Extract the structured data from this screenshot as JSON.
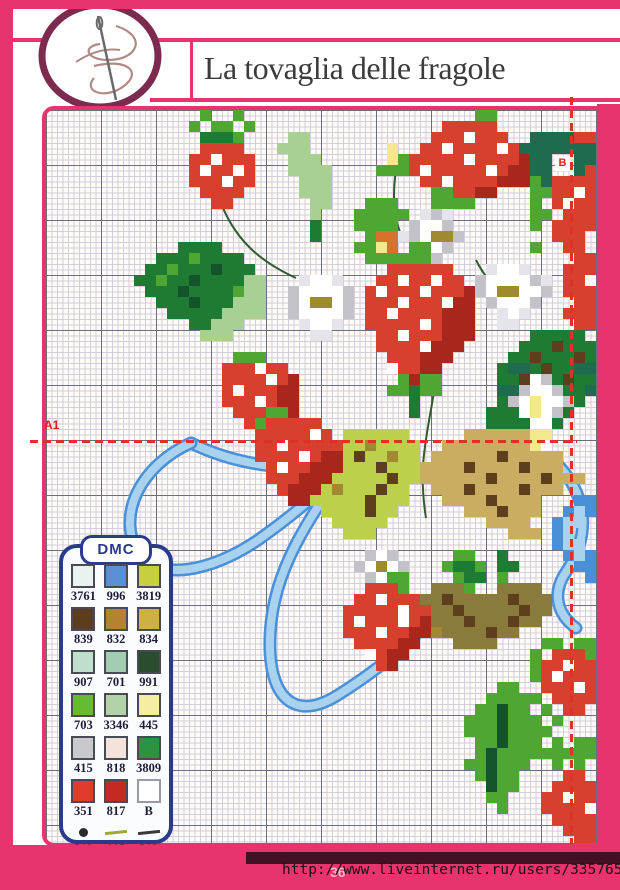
{
  "header": {
    "title": "La tovaglia delle fragole"
  },
  "footer": {
    "url": "http://www.liveinternet.ru/users/3357652/",
    "page_number": "36"
  },
  "legend": {
    "brand": "DMC",
    "entries": [
      {
        "code": "3761",
        "color": "#e9f2ef"
      },
      {
        "code": "996",
        "color": "#5b8fd6"
      },
      {
        "code": "3819",
        "color": "#c6cf3f"
      },
      {
        "code": "839",
        "color": "#5c3d20"
      },
      {
        "code": "832",
        "color": "#b28430"
      },
      {
        "code": "834",
        "color": "#cfb143"
      },
      {
        "code": "907",
        "color": "#bfdecb"
      },
      {
        "code": "701",
        "color": "#a3cdb3"
      },
      {
        "code": "991",
        "color": "#2c4c30"
      },
      {
        "code": "703",
        "color": "#66bb33"
      },
      {
        "code": "3346",
        "color": "#b2d2a6"
      },
      {
        "code": "445",
        "color": "#f4efa0"
      },
      {
        "code": "415",
        "color": "#c9c9cd"
      },
      {
        "code": "818",
        "color": "#f4e3da"
      },
      {
        "code": "3809",
        "color": "#2b9440"
      },
      {
        "code": "351",
        "color": "#e23a2e"
      },
      {
        "code": "817",
        "color": "#c32a21"
      },
      {
        "code": "B",
        "color": "#ffffff"
      }
    ],
    "symbols": [
      {
        "label": "310\np.\nnodi",
        "type": "dot",
        "color": "#2a2a2a"
      },
      {
        "label": "905\nps",
        "type": "line",
        "color": "#a3a832"
      },
      {
        "label": "310\nps",
        "type": "line",
        "color": "#3a3a3a"
      }
    ]
  },
  "pattern": {
    "markers": {
      "a1": "A1",
      "b": "B"
    },
    "cell_size": 11,
    "palette": {
      "r": "#d8402e",
      "R": "#a8261c",
      "w": "#ffffff",
      "g": "#4fa733",
      "G": "#1f7a33",
      "d": "#14542a",
      "k": "#1f6b4f",
      "l": "#a9d093",
      "Y": "#bcd04c",
      "y": "#f3e98c",
      "o": "#a08a30",
      "t": "#c9ad62",
      "n": "#8a7b3d",
      "b": "#5d3f1e",
      "B": "#4a90d9",
      "c": "#a9d2ef",
      "s": "#c2c2c8",
      "x": "#e4e4ea",
      "O": "#d9712c"
    },
    "motifs": [
      {
        "name": "right-teal-leaf",
        "col": 43,
        "row": 2,
        "rows": [
          ".kkkkrr",
          "kkkkkkk",
          "kkk..kk",
          "gkk..kr",
          ".gkkrrr"
        ]
      },
      {
        "name": "light-leaf-top",
        "col": 21,
        "row": 2,
        "rows": [
          ".ll",
          "lll",
          ".lll",
          ".llll",
          "..lll",
          "..lll",
          "...ll",
          "...l",
          "...G",
          "...G"
        ]
      },
      {
        "name": "left-big-leaf",
        "col": 8,
        "row": 12,
        "rows": [
          "....GGGG",
          "..GGGgGGGG",
          ".GGgGGGdGGG",
          "GGgGGdGGGGll",
          ".GGGdGGGGgll",
          "..GGGdGGGlll",
          "...GGGGGllll",
          ".....GGlll",
          "......lll"
        ]
      },
      {
        "name": "dark-mass-right",
        "col": 40,
        "row": 20,
        "rows": [
          "....GGGGG",
          "...GGGbGGG",
          "..GGbGGGbG",
          ".GkkGbGGkk",
          ".GGbGGGbGG",
          ".kkGGkkGGk",
          ".GGGGbGGG",
          "GGGbGGGG",
          "GGGGGGG"
        ]
      },
      {
        "name": "olive-leaf-center",
        "col": 24,
        "row": 29,
        "rows": [
          "...YYYYYY",
          "...YYoYYYY",
          "...YbYYoYY",
          "...YYYbYYY",
          "..YYYYYbYY",
          ".YoYYYbYY",
          "YYYYYbYYY",
          ".YYYYbYY",
          "..YYYYY",
          "...YYY"
        ]
      },
      {
        "name": "tan-leaf-right",
        "col": 34,
        "row": 29,
        "rows": [
          "....tttttt",
          "..tttttttttt",
          ".ttttttbttttt",
          "ttttbttttbttt",
          "ttttttbttttbttt",
          ".tttbttttbttt",
          "..ttttbtttt",
          "....tttbttt",
          "......tttt",
          "........ttt"
        ]
      },
      {
        "name": "brown-leaf-bottom",
        "col": 33,
        "row": 43,
        "rows": [
          "..nnnn..nnnn",
          ".nnbnnnnnbnnn",
          "nnnnbnnnnnbnn",
          ".onnnbnnnbnn",
          "..onnnnbnn",
          "....nnnn"
        ]
      },
      {
        "name": "oak-leaf-bottom",
        "col": 38,
        "row": 52,
        "rows": [
          "...gg",
          "..gggg",
          ".ggdgg",
          "gggdggg",
          "gggdgggg",
          ".ggdggg",
          ".gdgggg",
          "ggdggg",
          ".gdgg",
          "..dgg",
          "..gg",
          "...g"
        ]
      },
      {
        "name": "green-bits",
        "col": 35,
        "row": 40,
        "rows": [
          "..gg..G",
          ".gGGg.GG",
          "..gGG.g",
          "...g"
        ]
      },
      {
        "name": "green-mass",
        "col": 28,
        "row": 8,
        "rows": [
          ".ggg",
          "ggggg",
          "gggg",
          ".gOO",
          "ggyO",
          ".ggg"
        ]
      },
      {
        "name": "daisy-a",
        "col": 32,
        "row": 9,
        "rows": [
          "..xsx",
          ".swws",
          "xswoos",
          ".swws",
          "..xs"
        ]
      },
      {
        "name": "daisy-b",
        "col": 22,
        "row": 15,
        "rows": [
          ".xwwx",
          "swwwws",
          "swoows",
          "swwwws",
          ".xwwx",
          "..xx"
        ]
      },
      {
        "name": "daisy-c",
        "col": 39,
        "row": 14,
        "rows": [
          ".xwwx",
          "swwwwsx",
          "swoowws",
          ".swwws",
          "..xwx",
          "..xx"
        ]
      },
      {
        "name": "daisy-d",
        "col": 42,
        "row": 24,
        "rows": [
          "..ws",
          ".swws",
          "swywws",
          ".wyws",
          "..ww",
          "..yy",
          "..yw"
        ]
      },
      {
        "name": "daisy-e",
        "col": 28,
        "row": 40,
        "rows": [
          ".sws",
          "swows",
          ".sws",
          "..s"
        ]
      },
      {
        "name": "sprig-top",
        "col": 13,
        "row": 0,
        "rows": [
          ".g..g",
          "g.gg.g",
          ".GGGg"
        ]
      },
      {
        "name": "small-strawberry-top",
        "col": 13,
        "row": 3,
        "rows": [
          ".rrrr",
          "rrwrrr",
          "rwrrwr",
          "rrrwrr",
          ".rrrr",
          "..rr"
        ]
      },
      {
        "name": "bud-top",
        "col": 30,
        "row": 3,
        "rows": [
          ".y",
          ".yg",
          "ggg"
        ]
      },
      {
        "name": "top-big-strawberry",
        "col": 33,
        "row": 0,
        "rows": [
          "......gg",
          "...rrrrr",
          "..rrrwrrr",
          ".rrwrrrrwr",
          "rrrrrwrrrrR",
          "rwrrrrrwrRR",
          ".rrwrrrrRRR",
          "..ggrrRR",
          "..gggg"
        ]
      },
      {
        "name": "right-berry-top",
        "col": 44,
        "row": 6,
        "rows": [
          "g.rrrr",
          "ggrrwr",
          "g.rwrr",
          "gg.rrr",
          "g.rrrr",
          "..rrr",
          "g..rr"
        ]
      },
      {
        "name": "right-edge-berry",
        "col": 47,
        "row": 13,
        "rows": [
          ".rr",
          "rrr",
          "rrw",
          "rrr",
          ".rr",
          "rrr",
          ".rr"
        ]
      },
      {
        "name": "central-strawberry",
        "col": 29,
        "row": 12,
        "rows": [
          "....gg",
          "...ggg",
          "..rrrrrr",
          ".rrwrrwrr",
          "rwrrrwrrrR",
          "rrrwrrrwRR",
          "rrwrrrrRRR",
          "rrrrrwrRRR",
          ".rrwrrrRRR",
          ".rrrrwRRR",
          "..rrrRRR",
          "..wrrRR",
          "...gRgg",
          "..ggGgg",
          "....G",
          "....G"
        ]
      },
      {
        "name": "left-strawberry-1",
        "col": 16,
        "row": 22,
        "rows": [
          ".ggg",
          "rrrwrr",
          "rrrrwrR",
          "rwrrrRR",
          "rrrwrRR",
          ".rrrRRR",
          "..rrRR",
          "...RR"
        ]
      },
      {
        "name": "left-strawberry-2",
        "col": 19,
        "row": 27,
        "rows": [
          ".gg",
          "grrrrr",
          "rrrrrwr",
          "rrwrrrrr",
          "rrrrwrRR",
          ".rwrrRRR",
          ".rrrRRR",
          "..rRRR",
          "...RR"
        ]
      },
      {
        "name": "bottom-strawberry",
        "col": 27,
        "row": 42,
        "rows": [
          "....gg",
          "..rrrg",
          ".rrwrrr",
          "rrrrrwrr",
          "rwrrrwrR",
          "rrrwrrRR",
          ".rrrrRR",
          "..wrRR",
          "...rR"
        ]
      },
      {
        "name": "right-mid-strawberry",
        "col": 44,
        "row": 48,
        "rows": [
          ".gg.gg",
          "g.rrrg",
          "grrwrr",
          "grwrrr",
          ".rrrwr",
          "g.rrrr",
          ".g.rr",
          "..g"
        ]
      },
      {
        "name": "bottom-right-berry",
        "col": 45,
        "row": 57,
        "rows": [
          ".g.gg",
          "ggggg",
          ".g.g",
          "..rr",
          ".rrrr",
          "rrwrr",
          "rrrrw",
          ".rrrr",
          "..rrr",
          "...rr"
        ]
      },
      {
        "name": "right-edge-blue",
        "col": 46,
        "row": 35,
        "rows": [
          "..BB",
          ".BcB",
          "Bcc",
          "Bc",
          "Bcc",
          ".BcB",
          "..BB",
          "...B"
        ]
      }
    ],
    "ribbon_paths": [
      "M350,343 C280,368 200,360 145,333",
      "M145,333 C95,355 70,405 92,442 C112,472 165,462 212,430 C252,402 290,368 305,350",
      "M300,355 C255,420 222,470 224,540 C226,592 252,610 292,585 C332,560 372,528 400,490",
      "M512,355 C545,390 542,430 520,462 C505,484 512,505 530,518"
    ],
    "stem_paths": [
      "M172,85 C187,130 215,152 250,168",
      "M388,282 C380,330 372,358 380,408",
      "M350,60 C345,95 350,115 358,132",
      "M430,150 C440,170 455,185 470,195"
    ],
    "ribbon_colors": {
      "edge": "#4a90d9",
      "fill": "#a9d2ef"
    },
    "stem_color": "#2f5d2f"
  },
  "colors": {
    "accent_pink": "#e8336e",
    "badge_ring": "#7c2b4e",
    "navy": "#2a3a8c",
    "dash_red": "#e0302a",
    "dark_band": "#431024"
  }
}
